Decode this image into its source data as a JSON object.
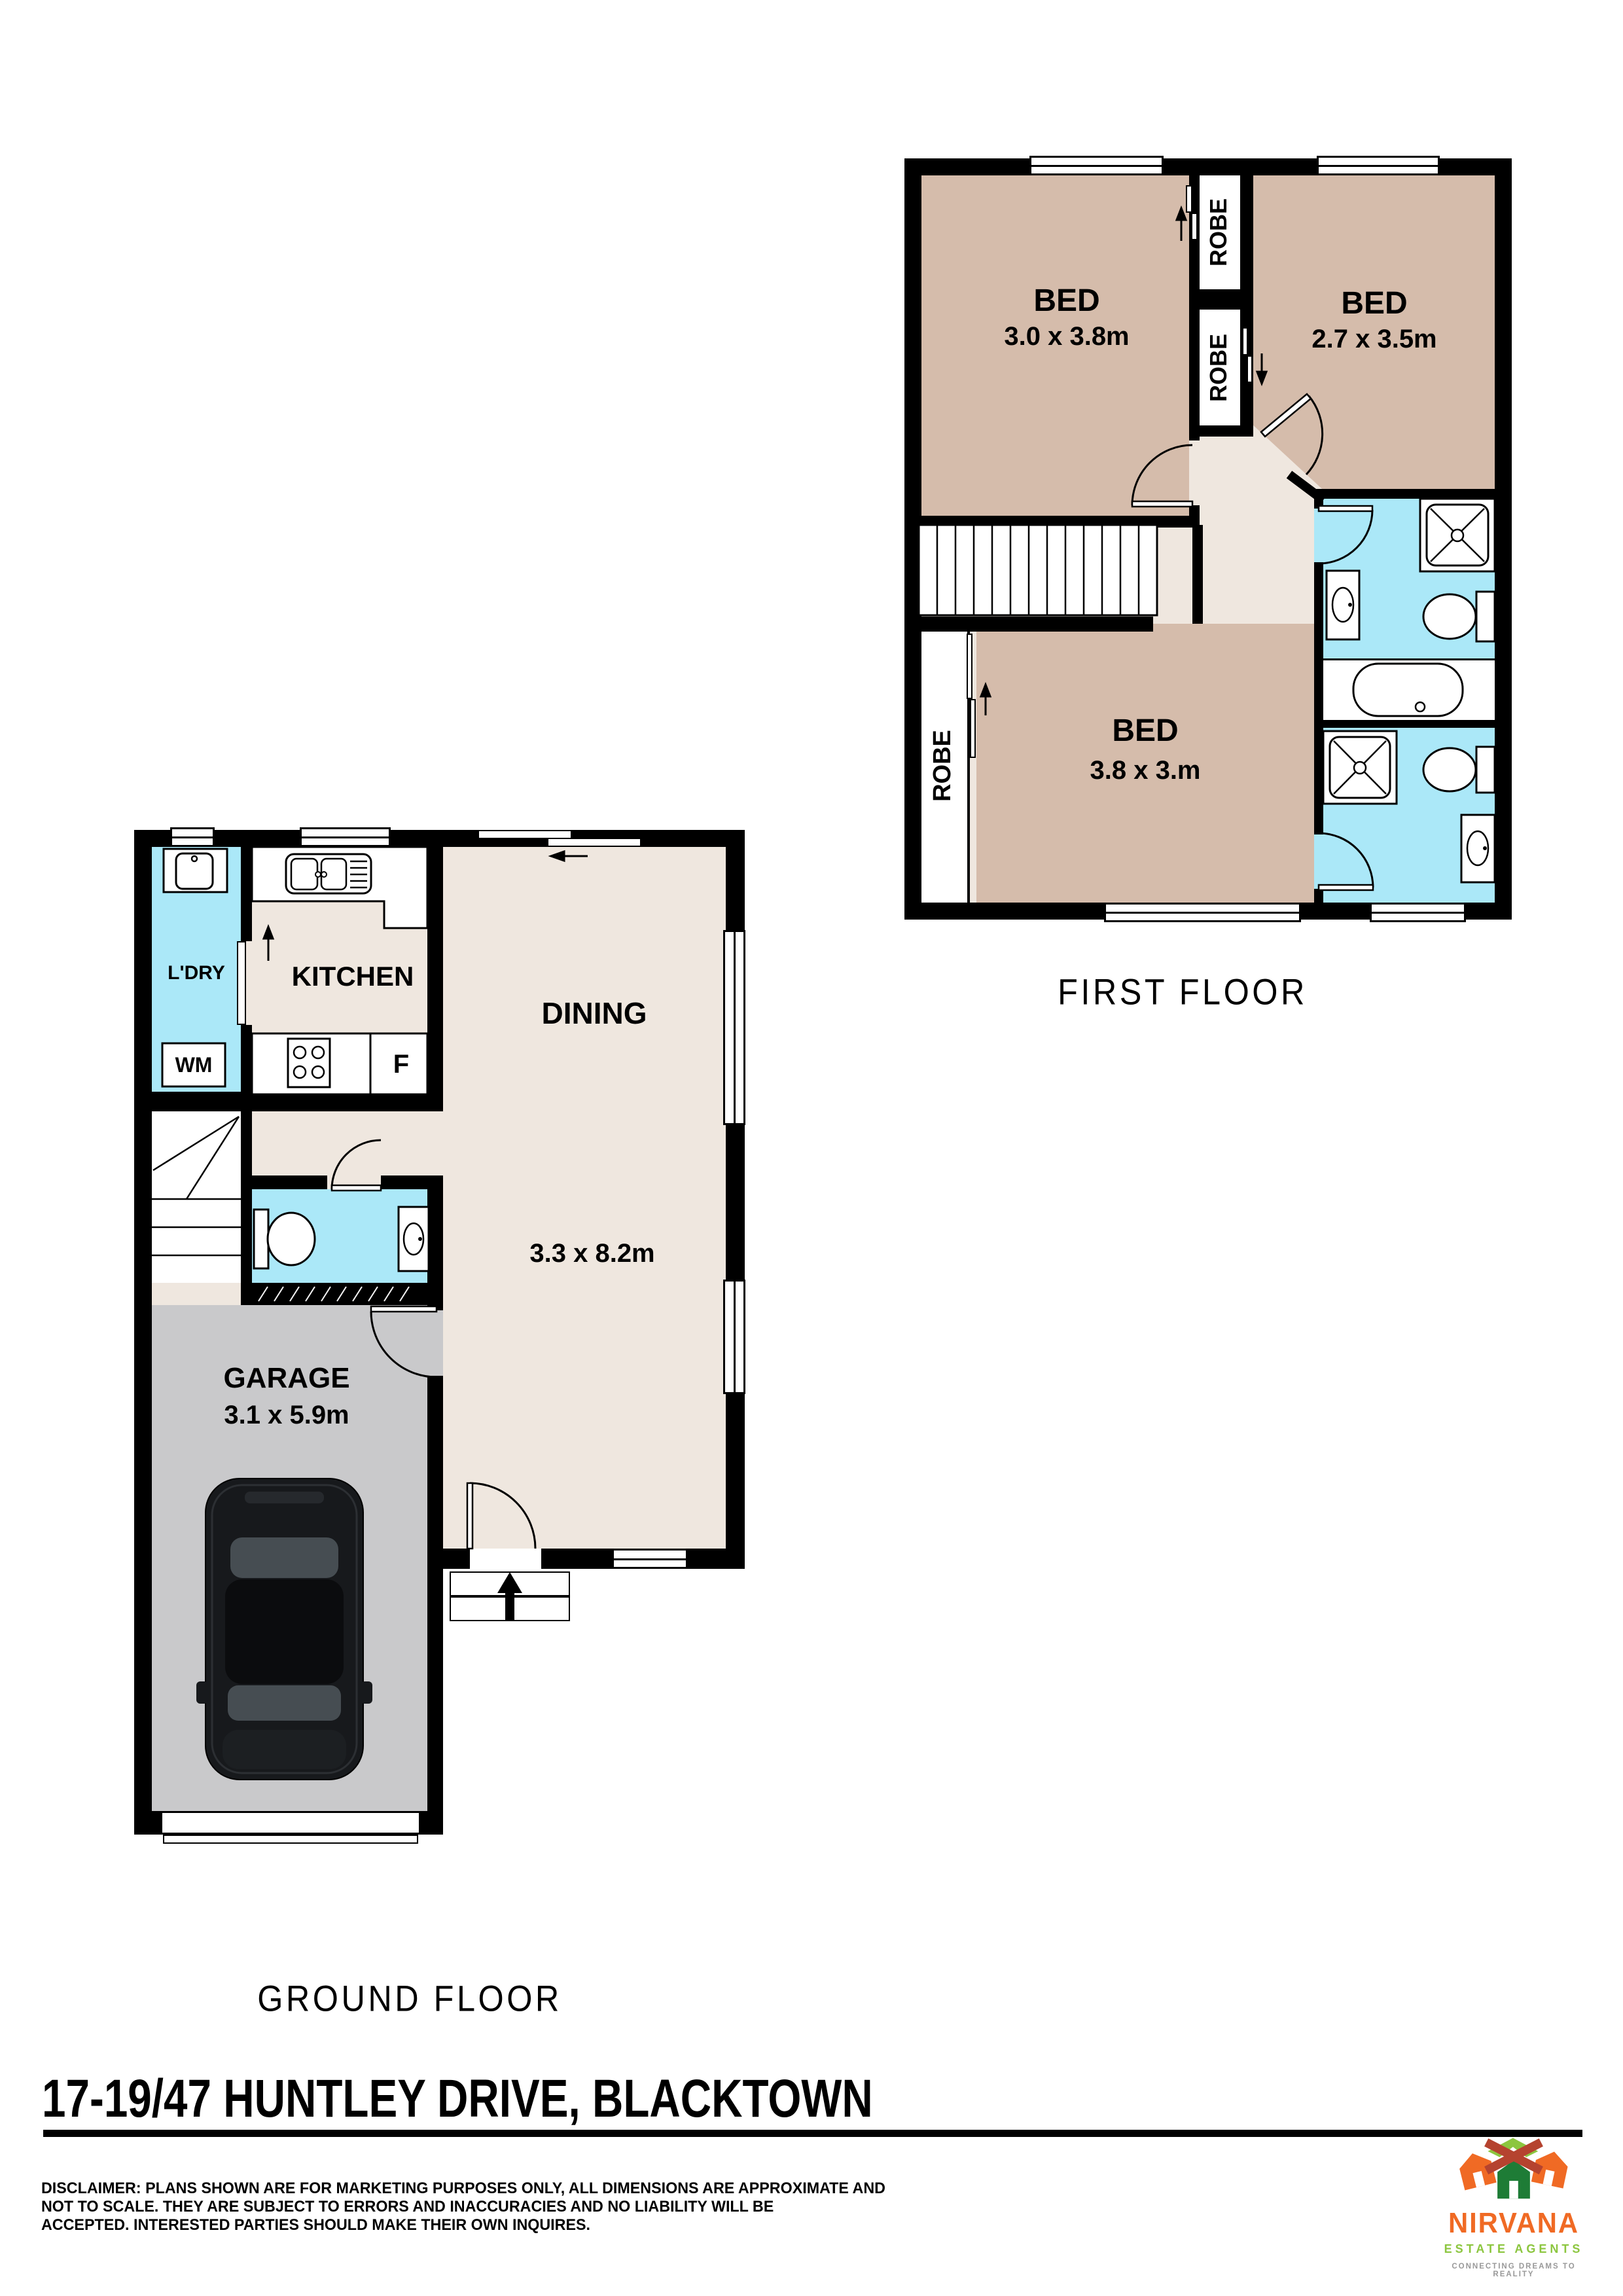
{
  "first_floor": {
    "title": "FIRST FLOOR",
    "beds": [
      {
        "label": "BED",
        "dims": "3.0 x 3.8m"
      },
      {
        "label": "BED",
        "dims": "2.7 x 3.5m"
      },
      {
        "label": "BED",
        "dims": "3.8 x 3.m"
      }
    ],
    "robes": [
      "ROBE",
      "ROBE",
      "ROBE"
    ]
  },
  "ground_floor": {
    "title": "GROUND FLOOR",
    "laundry_label": "L'DRY",
    "washing_machine_label": "WM",
    "kitchen_label": "KITCHEN",
    "fridge_label": "F",
    "dining": {
      "label": "DINING",
      "dims": "3.3 x 8.2m"
    },
    "garage": {
      "label": "GARAGE",
      "dims": "3.1 x 5.9m"
    }
  },
  "address": "17-19/47 HUNTLEY DRIVE, BLACKTOWN",
  "disclaimer": {
    "line1": "DISCLAIMER: PLANS SHOWN ARE FOR MARKETING PURPOSES ONLY, ALL DIMENSIONS ARE APPROXIMATE AND",
    "line2": "NOT TO SCALE. THEY ARE SUBJECT TO ERRORS AND INACCURACIES AND NO LIABILITY WILL BE",
    "line3": "ACCEPTED. INTERESTED PARTIES SHOULD MAKE THEIR OWN INQUIRES."
  },
  "logo": {
    "brand": "NIRVANA",
    "subtitle": "ESTATE AGENTS",
    "tagline": "CONNECTING DREAMS TO REALITY"
  },
  "colors": {
    "bedroom_tan": "#d5bcab",
    "hall_beige": "#efe7df",
    "wet_area_cyan": "#abe8f8",
    "garage_grey": "#c9c9cb",
    "wall_black": "#000000",
    "logo_orange": "#f06a24",
    "logo_green": "#8cc63f",
    "logo_dark_green": "#1e7c36",
    "logo_red": "#b5432f",
    "tagline_grey": "#999999"
  }
}
